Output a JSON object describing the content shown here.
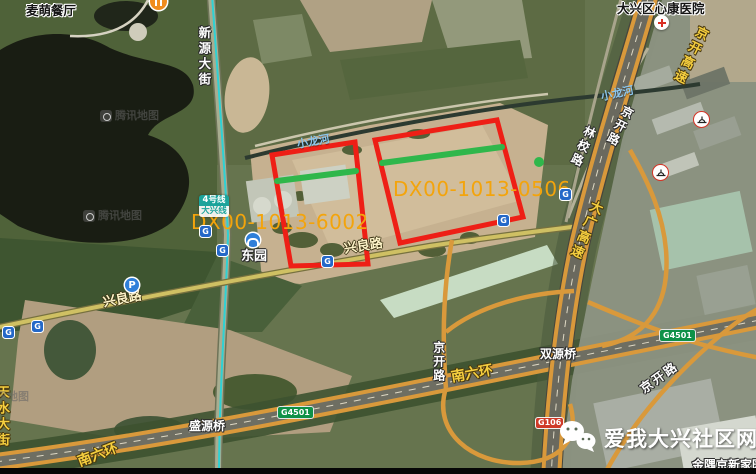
{
  "map": {
    "poi": {
      "restaurant": "麦萌餐厅",
      "hospital": "大兴区心康医院",
      "metro_station": "东园",
      "community": "金隅京新家园"
    },
    "roads": {
      "xinyuan_street": "新源大街",
      "jingkai_expressway": "京开高速",
      "jingkai_road_north": "京开路",
      "jingkai_road_mid": "京开路",
      "jingkai_road_southeast": "京开路",
      "linxiao_road": "林校路",
      "daguang_expressway": "大广高速",
      "xingliang_road_east": "兴良路",
      "xingliang_road_west": "兴良路",
      "tianshui_street": "天水大街",
      "south_sixth_ring_west": "南六环",
      "south_sixth_ring_east": "南六环",
      "shengyuan_bridge": "盛源桥",
      "shuangyuan_bridge": "双源桥"
    },
    "water": {
      "xiaolong_river_west": "小龙河",
      "xiaolong_river_east": "小龙河"
    },
    "badges": {
      "g4501_west": "G4501",
      "g4501_east": "G4501",
      "g106": "G106",
      "metro_line": "4号线",
      "metro_line_branch": "大兴线",
      "parking": "P"
    },
    "parcels": {
      "west": {
        "label": "DX00-1013-6002"
      },
      "east": {
        "label": "DX00-1013-0506"
      }
    },
    "watermark": {
      "text": "腾讯地图"
    }
  },
  "branding": {
    "site_name": "爱我大兴社区网"
  },
  "colors": {
    "parcel_outline": "#ee1f16",
    "parcel_marker": "#2fb74b",
    "parcel_label": "#f3a40c",
    "metro_line": "#2fd1d4",
    "highway_stripe": "#d9993b"
  }
}
